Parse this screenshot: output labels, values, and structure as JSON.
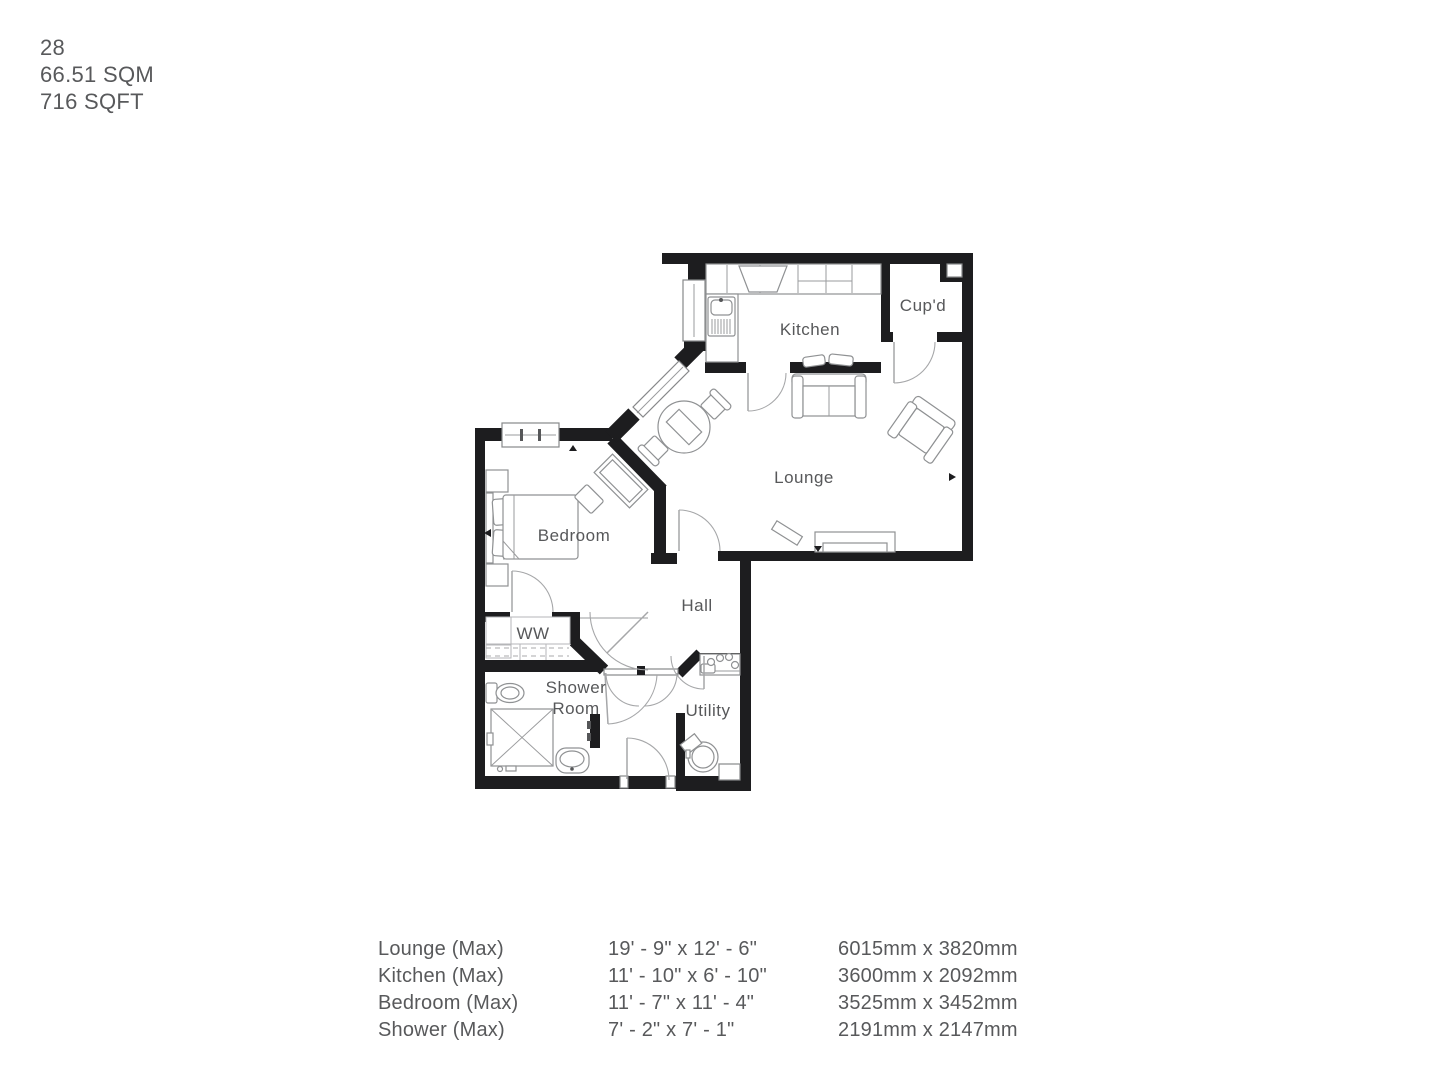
{
  "header": {
    "unit_number": "28",
    "area_sqm": "66.51 SQM",
    "area_sqft": "716 SQFT"
  },
  "plan": {
    "rooms": [
      {
        "label": "Kitchen"
      },
      {
        "label": "Cup'd"
      },
      {
        "label": "Lounge"
      },
      {
        "label": "Bedroom"
      },
      {
        "label": "Hall"
      },
      {
        "label": "WW"
      },
      {
        "label": "Shower"
      },
      {
        "label": "Room"
      },
      {
        "label": "Utility"
      }
    ]
  },
  "dimensions": {
    "rows": [
      {
        "room": "Lounge (Max)",
        "imperial": "19' - 9\" x 12' - 6\"",
        "metric": "6015mm x 3820mm"
      },
      {
        "room": "Kitchen (Max)",
        "imperial": "11' - 10\" x 6' - 10\"",
        "metric": "3600mm x 2092mm"
      },
      {
        "room": "Bedroom (Max)",
        "imperial": "11' - 7\" x 11' - 4\"",
        "metric": "3525mm x 3452mm"
      },
      {
        "room": "Shower (Max)",
        "imperial": "7' - 2\" x 7' - 1\"",
        "metric": "2191mm x 2147mm"
      }
    ]
  },
  "colors": {
    "wall": "#1d1d1f",
    "text": "#58595b",
    "furniture_stroke": "#8f9193"
  }
}
